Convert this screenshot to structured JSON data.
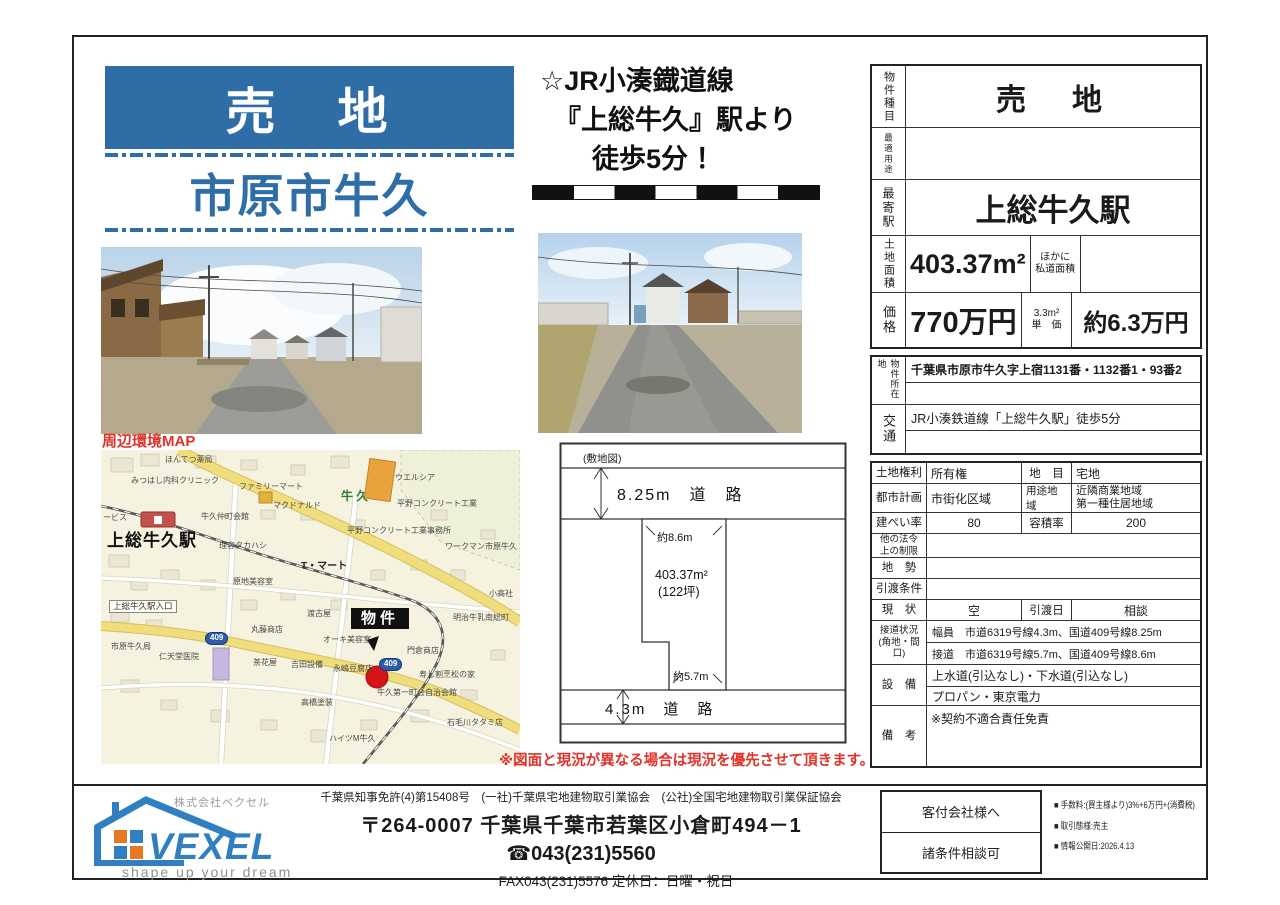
{
  "page": {
    "banner": "売　地",
    "location": "市原市牛久",
    "catch_line1": "☆JR小湊鐡道線",
    "catch_line2": "『上総牛久』駅より",
    "catch_line3": "徒歩5分 ！",
    "map_heading": "周辺環境MAP",
    "disclaimer": "※図面と現況が異なる場合は現況を優先させて頂きます。"
  },
  "site_plan": {
    "caption": "(敷地図)",
    "road_top": "8.25m　道　路",
    "road_bottom": "4.3m　道　路",
    "frontage_top": "約8.6m",
    "frontage_bottom": "約5.7m",
    "area": "403.37m²",
    "area_tsubo": "(122坪)"
  },
  "table": {
    "r1": {
      "label": "物件種目",
      "value": "売　地"
    },
    "r2": {
      "label": "最適用途",
      "value": ""
    },
    "r3": {
      "label": "最寄駅",
      "value": "上総牛久駅"
    },
    "r4": {
      "label": "土地面積",
      "value": "403.37m²",
      "note": "ほかに\n私道面積",
      "extra": ""
    },
    "r5": {
      "label": "価格",
      "value": "770万円",
      "note": "3.3m²\n単　価",
      "extra": "約6.3万円"
    },
    "r6": {
      "label": "物件所在地",
      "value": "千葉県市原市牛久字上宿1131番・1132番1・93番2"
    },
    "r7": {
      "label": "交通",
      "value": "JR小湊鉄道線「上総牛久駅」徒歩5分"
    },
    "r8": {
      "label": "土地権利",
      "value": "所有権",
      "label2": "地　目",
      "value2": "宅地"
    },
    "r9": {
      "label": "都市計画",
      "value": "市街化区域",
      "label2": "用途地域",
      "value2": "近隣商業地域\n第一種住居地域"
    },
    "r10": {
      "label": "建ぺい率",
      "value": "80",
      "label2": "容積率",
      "value2": "200"
    },
    "r11": {
      "label": "他の法令\n上の制限",
      "value": ""
    },
    "r12": {
      "label": "地　勢",
      "value": ""
    },
    "r13": {
      "label": "引渡条件",
      "value": ""
    },
    "r14": {
      "label": "現　状",
      "value": "空",
      "label2": "引渡日",
      "value2": "相談"
    },
    "r15": {
      "label": "接道状況\n(角地・間口)",
      "line1": "幅員　市道6319号線4.3m、国道409号線8.25m",
      "line2": "接道　市道6319号線5.7m、国道409号線8.6m"
    },
    "r16": {
      "label": "設　備",
      "line1": "上水道(引込なし)・下水道(引込なし)",
      "line2": "プロパン・東京電力"
    },
    "r17": {
      "label": "備　考",
      "value": "※契約不適合責任免責"
    }
  },
  "map": {
    "labels": [
      {
        "t": "ほんてつ薬局",
        "x": 64,
        "y": 6
      },
      {
        "t": "みつはし内科クリニック",
        "x": 30,
        "y": 27
      },
      {
        "t": "ファミリーマート",
        "x": 138,
        "y": 33
      },
      {
        "t": "マクドナルド",
        "x": 172,
        "y": 52
      },
      {
        "t": "牛久仲町会館",
        "x": 100,
        "y": 63
      },
      {
        "t": "理容タカハシ",
        "x": 118,
        "y": 92
      },
      {
        "t": "原地美容室",
        "x": 132,
        "y": 128
      },
      {
        "t": "ービス",
        "x": 2,
        "y": 64
      },
      {
        "t": "上総牛久駅",
        "x": 6,
        "y": 82,
        "c": "stn"
      },
      {
        "t": "牛久",
        "x": 240,
        "y": 40,
        "c": "grn"
      },
      {
        "t": "ウエルシア",
        "x": 294,
        "y": 24
      },
      {
        "t": "平野コンクリート工業",
        "x": 296,
        "y": 50
      },
      {
        "t": "平野コンクリート工業事務所",
        "x": 246,
        "y": 77
      },
      {
        "t": "ワークマン市原牛久",
        "x": 344,
        "y": 93
      },
      {
        "t": "T・マート",
        "x": 200,
        "y": 112,
        "c": "md"
      },
      {
        "t": "小高社",
        "x": 388,
        "y": 140
      },
      {
        "t": "明治牛乳南総町",
        "x": 352,
        "y": 164
      },
      {
        "t": "渡古屋",
        "x": 206,
        "y": 160
      },
      {
        "t": "上総牛久駅入口",
        "x": 8,
        "y": 150,
        "c": "box"
      },
      {
        "t": "丸藤商店",
        "x": 150,
        "y": 176
      },
      {
        "t": "市原牛久局",
        "x": 10,
        "y": 193
      },
      {
        "t": "仁天堂医院",
        "x": 58,
        "y": 203
      },
      {
        "t": "茶花屋",
        "x": 152,
        "y": 209
      },
      {
        "t": "吉田設備",
        "x": 190,
        "y": 211
      },
      {
        "t": "オーキ美容室",
        "x": 222,
        "y": 186
      },
      {
        "t": "永嶋豆腐店",
        "x": 232,
        "y": 215
      },
      {
        "t": "門倉商店",
        "x": 306,
        "y": 197
      },
      {
        "t": "寿し割烹松の家",
        "x": 318,
        "y": 221
      },
      {
        "t": "牛久第一町会自治会館",
        "x": 276,
        "y": 239
      },
      {
        "t": "高橋塗装",
        "x": 200,
        "y": 249
      },
      {
        "t": "石毛川タタミ店",
        "x": 346,
        "y": 269
      },
      {
        "t": "ハイツM牛久",
        "x": 228,
        "y": 285
      },
      {
        "t": "409",
        "x": 104,
        "y": 182,
        "c": "shield"
      },
      {
        "t": "409",
        "x": 278,
        "y": 208,
        "c": "shield"
      },
      {
        "t": "物件",
        "x": 250,
        "y": 158,
        "c": "tgt"
      }
    ]
  },
  "footer": {
    "company_kana": "株式会社ベクセル",
    "company_name": "VEXEL",
    "tagline": "shape up your dream",
    "license_line": "千葉県知事免許(4)第15408号　(一社)千葉県宅地建物取引業協会　(公社)全国宅地建物取引業保証協会",
    "address": "〒264-0007 千葉県千葉市若葉区小倉町494－1",
    "phone": "☎043(231)5560",
    "fax_line": "FAX043(231)5576 定休日：日曜・祝日",
    "box_top": "客付会社様へ",
    "box_bottom": "諸条件相談可",
    "bullets": [
      "■ 手数料:(買主様より)3%+6万円+(消費税)",
      "■ 取引態様:売主",
      "■ 情報公開日:2026.4.13"
    ]
  },
  "colors": {
    "accent_blue": "#2e6da6",
    "alert_red": "#e03228",
    "map_bg": "#f6f2e0",
    "map_road_yellow": "#f0dd7c",
    "marker_red": "#d61418",
    "logo_blue": "#2f7fc1",
    "logo_orange": "#e87722"
  }
}
